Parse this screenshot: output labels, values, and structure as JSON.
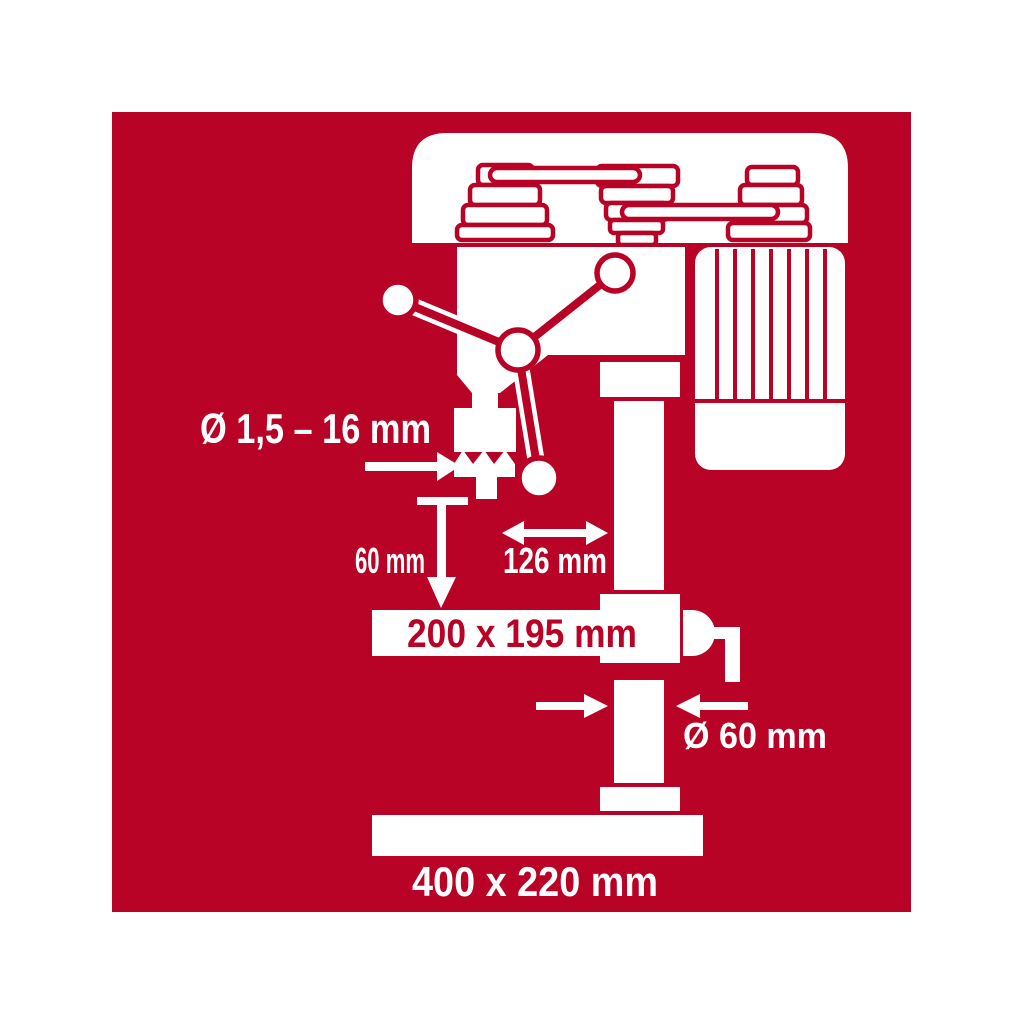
{
  "colors": {
    "page_background": "#ffffff",
    "panel_red": "#b80226",
    "artwork_white": "#ffffff"
  },
  "dimensions": {
    "chuck_capacity": "Ø 1,5 – 16 mm",
    "spindle_stroke": "60 mm",
    "throat_depth": "126 mm",
    "table_size": "200 x 195 mm",
    "column_diameter": "Ø 60 mm",
    "base_size": "400 x 220 mm"
  }
}
